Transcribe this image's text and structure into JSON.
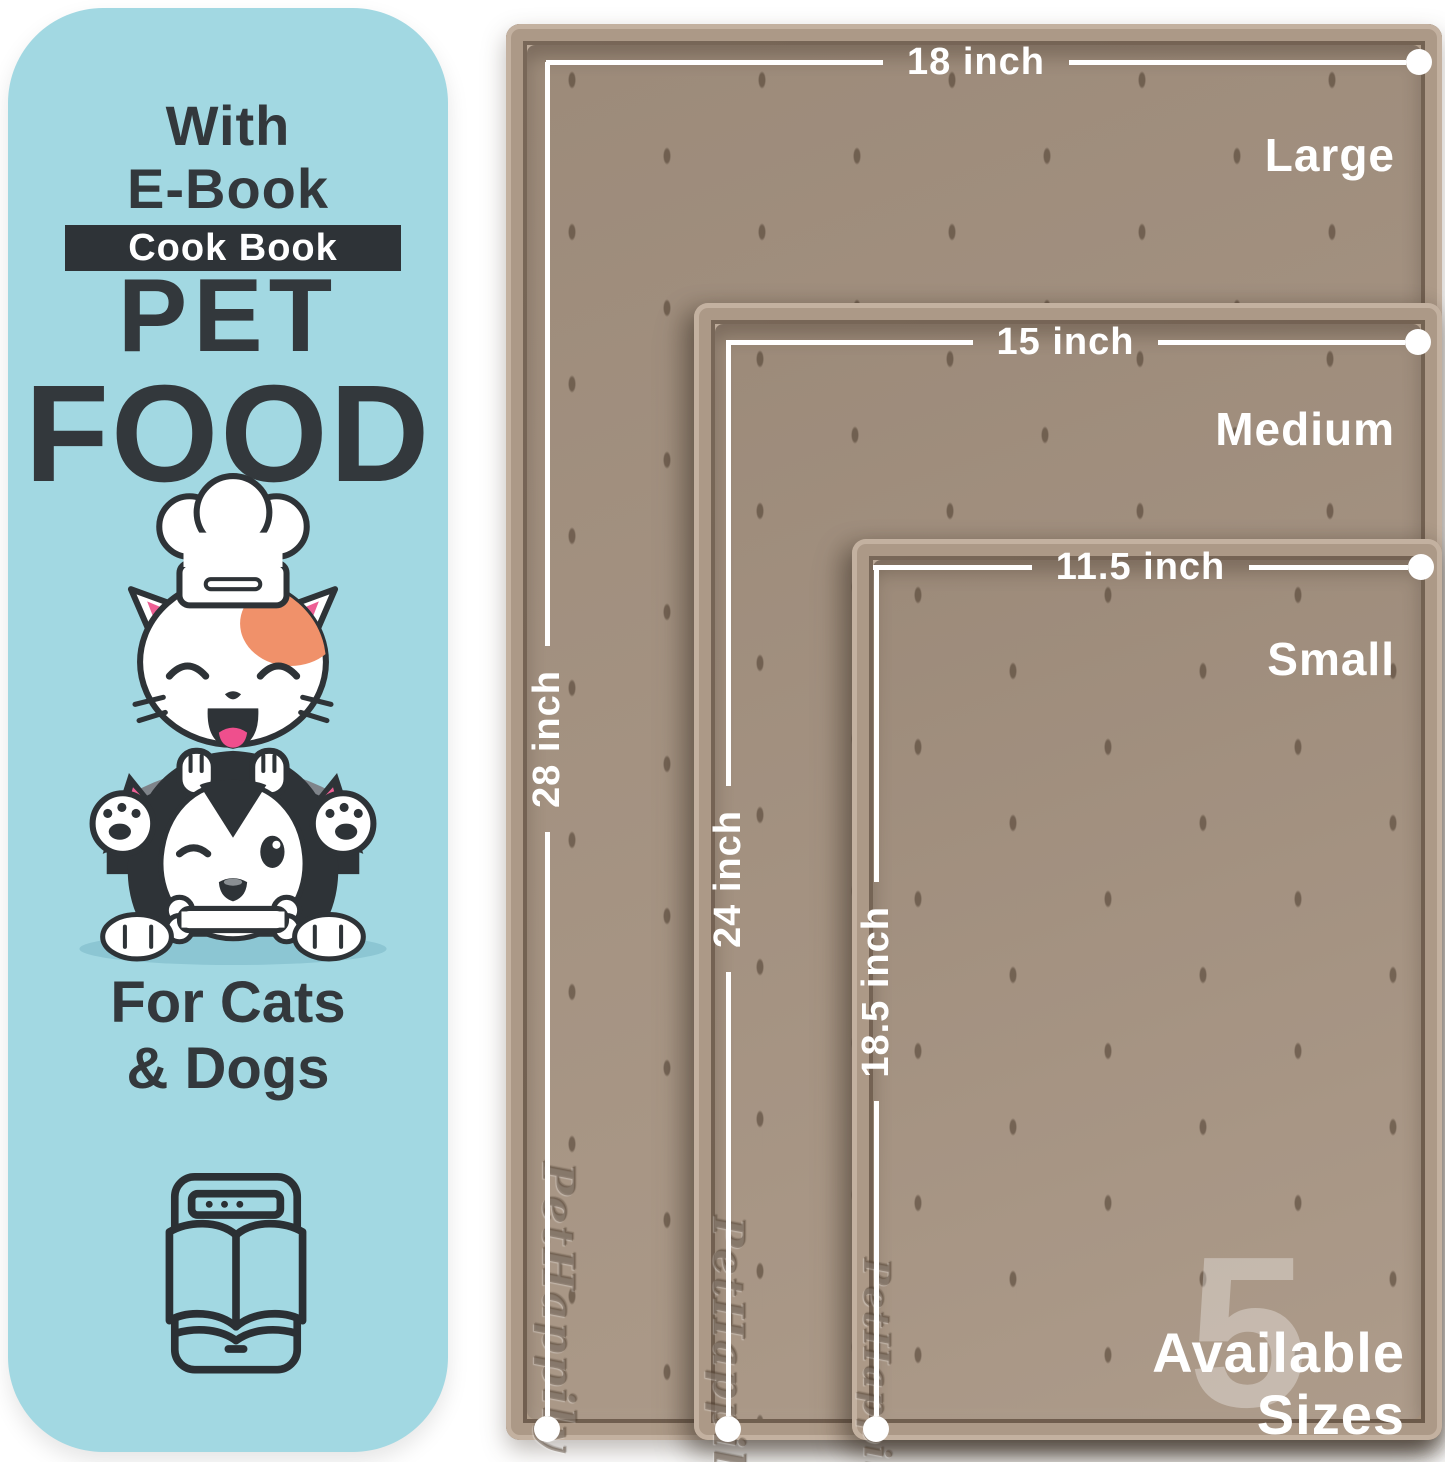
{
  "panel": {
    "eyebrow": [
      "With",
      "E-Book"
    ],
    "badge": "Cook Book",
    "title": [
      "PET",
      "FOOD"
    ],
    "subtitle": [
      "For Cats",
      "& Dogs"
    ]
  },
  "mats": [
    {
      "name": "Large",
      "width": "18 inch",
      "height": "28 inch"
    },
    {
      "name": "Medium",
      "width": "15 inch",
      "height": "24 inch"
    },
    {
      "name": "Small",
      "width": "11.5 inch",
      "height": "18.5 inch"
    }
  ],
  "brand_embossed": "PetHappily",
  "availability": {
    "count": "5",
    "line1": "Available",
    "line2": "Sizes"
  },
  "icons": [
    "chef-hat-icon",
    "cat-face-icon",
    "dog-face-icon",
    "bone-icon",
    "ebook-icon"
  ],
  "colors": {
    "panel_blue": "#a2d8e2",
    "dark_text": "#33383c",
    "mat_tan": "#a89583",
    "dimension_line": "#ffffff",
    "accent_orange": "#f0916a",
    "accent_pink": "#ee5f94"
  }
}
